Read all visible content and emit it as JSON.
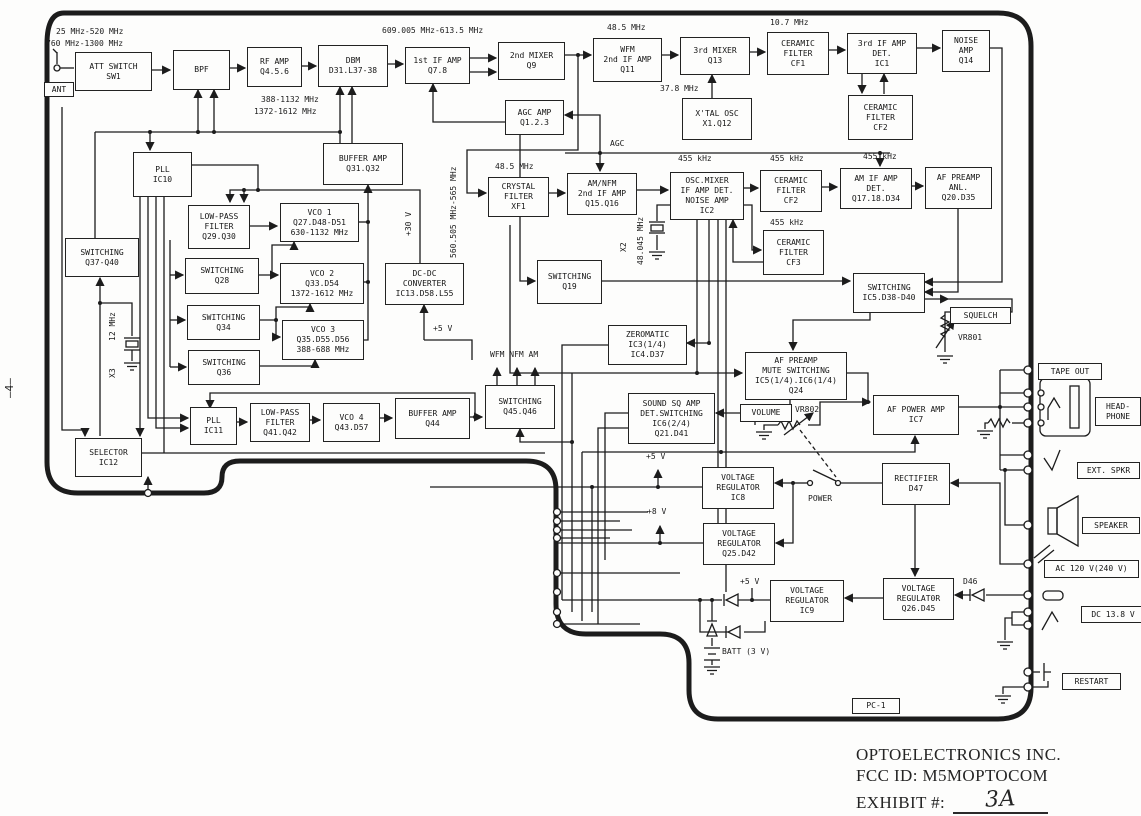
{
  "title": "Receiver block diagram - FCC exhibit",
  "blocks": {
    "att_switch": {
      "lines": [
        "ATT SWITCH",
        "SW1"
      ]
    },
    "bpf": {
      "lines": [
        "BPF"
      ]
    },
    "rf_amp": {
      "lines": [
        "RF AMP",
        "Q4.5.6"
      ]
    },
    "dbm": {
      "lines": [
        "DBM",
        "D31.L37-38"
      ]
    },
    "if1": {
      "lines": [
        "1st IF AMP",
        "Q7.8"
      ]
    },
    "mixer2": {
      "lines": [
        "2nd MIXER",
        "Q9"
      ]
    },
    "wfm_if2": {
      "lines": [
        "WFM",
        "2nd IF AMP",
        "Q11"
      ]
    },
    "mixer3": {
      "lines": [
        "3rd MIXER",
        "Q13"
      ]
    },
    "cf1": {
      "lines": [
        "CERAMIC",
        "FILTER",
        "CF1"
      ]
    },
    "if3_det": {
      "lines": [
        "3rd IF AMP",
        "DET.",
        "IC1"
      ]
    },
    "noise_amp": {
      "lines": [
        "NOISE",
        "AMP",
        "Q14"
      ]
    },
    "xtal_osc": {
      "lines": [
        "X'TAL OSC",
        "X1.Q12"
      ]
    },
    "cf2_top": {
      "lines": [
        "CERAMIC",
        "FILTER",
        "CF2"
      ]
    },
    "agc_amp": {
      "lines": [
        "AGC AMP",
        "Q1.2.3"
      ]
    },
    "pll10": {
      "lines": [
        "PLL",
        "IC10"
      ]
    },
    "buffer31": {
      "lines": [
        "BUFFER AMP",
        "Q31.Q32"
      ]
    },
    "crystal_filter": {
      "lines": [
        "CRYSTAL",
        "FILTER",
        "XF1"
      ]
    },
    "amnfm_if2": {
      "lines": [
        "AM/NFM",
        "2nd IF AMP",
        "Q15.Q16"
      ]
    },
    "ic2": {
      "lines": [
        "OSC.MIXER",
        "IF AMP DET.",
        "NOISE AMP",
        "IC2"
      ]
    },
    "cf2": {
      "lines": [
        "CERAMIC",
        "FILTER",
        "CF2"
      ]
    },
    "am_if_det": {
      "lines": [
        "AM IF AMP",
        "DET.",
        "Q17.18.D34"
      ]
    },
    "af_preamp_anl": {
      "lines": [
        "AF PREAMP",
        "ANL.",
        "Q20.D35"
      ]
    },
    "lpf29": {
      "lines": [
        "LOW-PASS",
        "FILTER",
        "Q29.Q30"
      ]
    },
    "vco1": {
      "lines": [
        "VCO 1",
        "Q27.D48-D51",
        "630-1132 MHz"
      ]
    },
    "sw3740": {
      "lines": [
        "SWITCHING",
        "Q37-Q40"
      ]
    },
    "sw28": {
      "lines": [
        "SWITCHING",
        "Q28"
      ]
    },
    "vco2": {
      "lines": [
        "VCO 2",
        "Q33.D54",
        "1372-1612 MHz"
      ]
    },
    "sw34": {
      "lines": [
        "SWITCHING",
        "Q34"
      ]
    },
    "vco3": {
      "lines": [
        "VCO 3",
        "Q35.D55.D56",
        "388-688 MHz"
      ]
    },
    "sw36": {
      "lines": [
        "SWITCHING",
        "Q36"
      ]
    },
    "dcdc": {
      "lines": [
        "DC-DC",
        "CONVERTER",
        "IC13.D58.L55"
      ]
    },
    "sw19": {
      "lines": [
        "SWITCHING",
        "Q19"
      ]
    },
    "cf3": {
      "lines": [
        "CERAMIC",
        "FILTER",
        "CF3"
      ]
    },
    "sw_ic5": {
      "lines": [
        "SWITCHING",
        "IC5.D38-D40"
      ]
    },
    "zeromatic": {
      "lines": [
        "ZEROMATIC",
        "IC3(1/4)",
        "IC4.D37"
      ]
    },
    "mute_sw": {
      "lines": [
        "AF PREAMP",
        "MUTE SWITCHING",
        "IC5(1/4).IC6(1/4)",
        "Q24"
      ]
    },
    "sound_sq": {
      "lines": [
        "SOUND SQ AMP",
        "DET.SWITCHING",
        "IC6(2/4)",
        "Q21.D41"
      ]
    },
    "pll11": {
      "lines": [
        "PLL",
        "IC11"
      ]
    },
    "lpf41": {
      "lines": [
        "LOW-PASS",
        "FILTER",
        "Q41.Q42"
      ]
    },
    "vco4": {
      "lines": [
        "VCO 4",
        "Q43.D57"
      ]
    },
    "selector": {
      "lines": [
        "SELECTOR",
        "IC12"
      ]
    },
    "buffer44": {
      "lines": [
        "BUFFER AMP",
        "Q44"
      ]
    },
    "sw4546": {
      "lines": [
        "SWITCHING",
        "Q45.Q46"
      ]
    },
    "af_power": {
      "lines": [
        "AF POWER AMP",
        "IC7"
      ]
    },
    "vreg_ic8": {
      "lines": [
        "VOLTAGE",
        "REGULATOR",
        "IC8"
      ]
    },
    "rectifier": {
      "lines": [
        "RECTIFIER",
        "D47"
      ]
    },
    "vreg_q25": {
      "lines": [
        "VOLTAGE",
        "REGULATOR",
        "Q25.D42"
      ]
    },
    "vreg_ic9": {
      "lines": [
        "VOLTAGE",
        "REGULATOR",
        "IC9"
      ]
    },
    "vreg_q26": {
      "lines": [
        "VOLTAGE",
        "REGULAT0R",
        "Q26.D45"
      ]
    }
  },
  "tags": {
    "ant": "ANT",
    "squelch": "SQUELCH",
    "volume": "VOLUME",
    "pc1": "PC-1",
    "tape_out": "TAPE OUT",
    "headphone1": "HEAD-",
    "headphone2": "PHONE",
    "ext_spkr": "EXT. SPKR",
    "speaker": "SPEAKER",
    "ac": "AC 120 V(240 V)",
    "dc": "DC 13.8 V",
    "restart": "RESTART"
  },
  "labels": {
    "f_in1": "25 MHz-520 MHz",
    "f_in2": "760 MHz-1300 MHz",
    "f_if1": "609.005 MHz-613.5 MHz",
    "f_485_top": "48.5 MHz",
    "f_107": "10.7 MHz",
    "f_378": "37.8 MHz",
    "f_388_1132": "388-1132 MHz",
    "f_1372": "1372-1612 MHz",
    "agc": "AGC",
    "f_485_mid": "48.5 MHz",
    "k455_a": "455 kHz",
    "k455_b": "455 kHz",
    "k455_c": "455 kHz",
    "k455_d": "455 kHz",
    "x2": "X2",
    "f_48045": "48.045 MHz",
    "x3": "X3",
    "f_12": "12 MHz",
    "v30": "+30 V",
    "f_560": "560.505 MHz-565 MHz",
    "modes": "WFM NFM AM",
    "v5_a": "+5 V",
    "v5_b": "+5 V",
    "v8": "+8 V",
    "v5_c": "+5 V",
    "power": "POWER",
    "vr802": "VR802",
    "vr801": "VR801",
    "d46": "D46",
    "batt": "BATT (3 V)",
    "page_no": "—4—"
  },
  "footer": {
    "company": "OPTOELECTRONICS INC.",
    "fcc": "FCC ID:  M5MOPTOCOM",
    "exhibit_label": "EXHIBIT #:",
    "exhibit_value": "3A"
  },
  "colors": {
    "line": "#1c1c1c",
    "paper": "#fdfdfc"
  }
}
